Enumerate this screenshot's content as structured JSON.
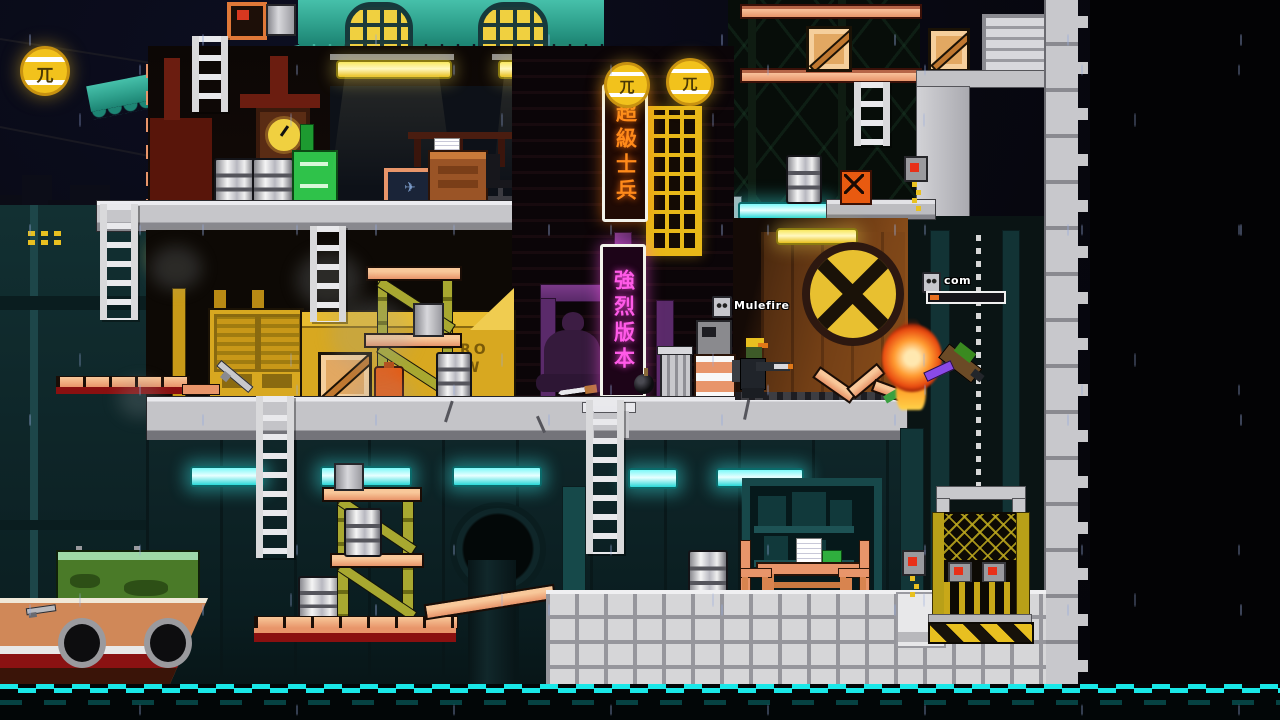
{
  "scene": {
    "title": "night chinatown dock level",
    "players": [
      {
        "label": "Mulefire",
        "badge": "rank-badge",
        "state": "standing-aiming-right"
      },
      {
        "label": "com",
        "badge": "rank-badge",
        "state": "falling-hit",
        "health_percent": 12,
        "health_fill_css": "width:9px"
      }
    ],
    "signs": {
      "lantern_glyph": "兀",
      "neon_orange_text": "超級士兵",
      "neon_pink_text": "強烈版本",
      "wall_number": "74",
      "container_stencil_1": "RO",
      "container_stencil_2": "W"
    },
    "icons": {
      "airplane_picture_glyph": "✈",
      "names": [
        "lantern-sign",
        "neon-sign",
        "lattice-window",
        "clock",
        "buddha-statue",
        "bomb-pickup",
        "knife-pickup",
        "gun-pickup",
        "crate",
        "barrel",
        "jerry-can",
        "trash-can",
        "ladder",
        "elevator-cage",
        "hazard-stripes",
        "sewer-pipe",
        "boat",
        "explosion",
        "fire",
        "rank-badge-icon",
        "red-button"
      ]
    },
    "colors": {
      "neon_orange": "#ff8a1a",
      "neon_pink": "#ff5ae8",
      "glow_cyan": "#3cf2f2",
      "lantern_yellow": "#f2c21c",
      "roof_teal": "#2fa18d",
      "platform_salmon": "#f0a878",
      "platform_gray": "#c6c6ca",
      "brick_gray": "#d6d6d8",
      "hazard_yellow": "#e8c020",
      "water_line_cyan": "#19e8e8",
      "health_fill_orange": "#e87020"
    }
  }
}
